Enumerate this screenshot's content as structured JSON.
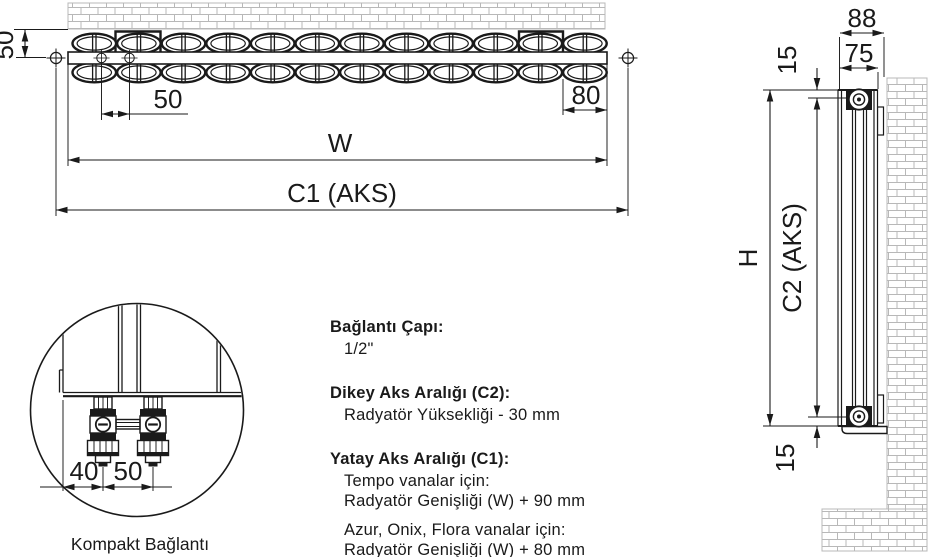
{
  "top_view": {
    "labels": {
      "wall_offset_50": "50",
      "port_spacing_50": "50",
      "end_offset_80": "80",
      "width_w": "W",
      "c1_axis": "C1 (AKS)"
    }
  },
  "side_view": {
    "labels": {
      "depth_88": "88",
      "depth_75": "75",
      "top_offset_15": "15",
      "bottom_offset_15": "15",
      "height_h": "H",
      "c2_axis": "C2 (AKS)"
    }
  },
  "detail_view": {
    "labels": {
      "dim_40": "40",
      "dim_50": "50"
    },
    "caption": "Kompakt Bağlantı"
  },
  "specs": {
    "connection_diameter": {
      "heading": "Bağlantı Çapı:",
      "value": "1/2\""
    },
    "vertical_axis": {
      "heading": "Dikey Aks Aralığı (C2):",
      "value": "Radyatör Yüksekliği - 30 mm"
    },
    "horizontal_axis": {
      "heading": "Yatay Aks Aralığı (C1):",
      "tempo_label": "Tempo vanalar için:",
      "tempo_value": "Radyatör Genişliği (W) + 90 mm",
      "other_label": "Azur, Onix, Flora vanalar için:",
      "other_value": "Radyatör Genişliği (W) + 80 mm"
    }
  },
  "colors": {
    "line": "#1a1a1a",
    "brick_line": "#b8b8b8",
    "background": "#ffffff"
  }
}
